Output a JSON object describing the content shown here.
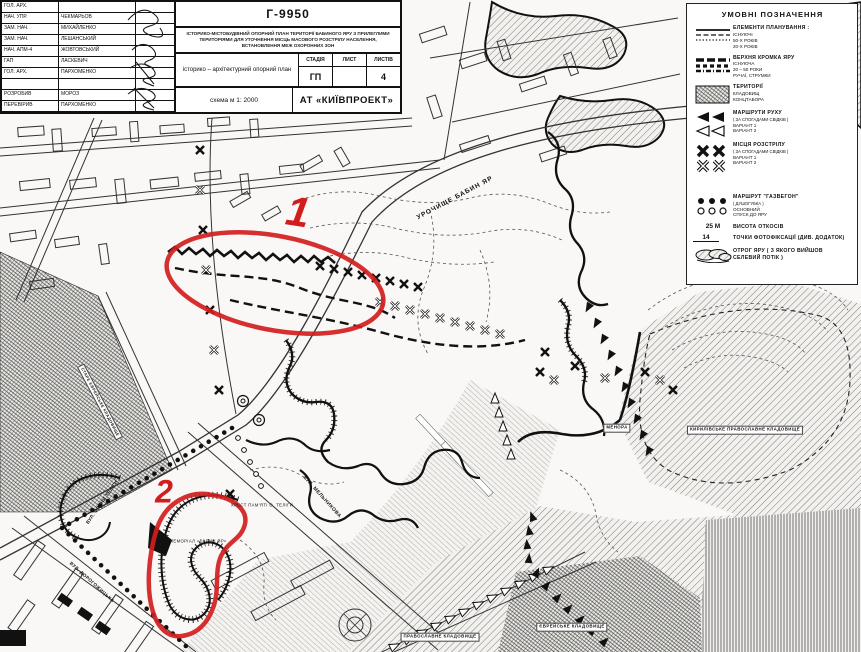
{
  "title_block": {
    "rows": [
      {
        "role": "ГОЛ. АРХ.",
        "name": ""
      },
      {
        "role": "НАЧ. УПР.",
        "name": "ЧЕКМАРЬОВ"
      },
      {
        "role": "ЗАМ. НАЧ.",
        "name": "МИХАЙЛЕНКО"
      },
      {
        "role": "ЗАМ. НАЧ.",
        "name": "ЛЕШАНСЬКИЙ"
      },
      {
        "role": "НАЧ. АПМ-4",
        "name": "ЖОВТОВСЬКИЙ"
      },
      {
        "role": "ГАП",
        "name": "ЛАСКЕВИЧ"
      },
      {
        "role": "ГОЛ. АРХ.",
        "name": "ПАРХОМЕНКО"
      },
      {
        "role": "",
        "name": ""
      },
      {
        "role": "РОЗРОБИВ",
        "name": "МОРОЗ"
      },
      {
        "role": "ПЕРЕВІРИВ",
        "name": "ПАРХОМЕНКО"
      }
    ],
    "project_code": "Г-9950",
    "description": "ІСТОРИКО-МІСТОБУДІВНИЙ ОПОРНИЙ ПЛАН ТЕРИТОРІЇ БАБИНОГО ЯРУ З ПРИЛЕГЛИМИ ТЕРИТОРІЯМИ ДЛЯ УТОЧНЕННЯ МІСЦЬ МАСОВОГО РОЗСТРІЛУ НАСЕЛЕННЯ, ВСТАНОВЛЕННЯ МЕЖ ОХОРОННИХ ЗОН",
    "doc_title": "історико – архітектурний опорний план",
    "stage_label": "СТАДІЯ",
    "sheet_label": "ЛИСТ",
    "sheets_label": "ЛИСТІВ",
    "stage_value": "ГП",
    "sheet_value": "",
    "sheets_value": "4",
    "scheme": "схема м 1: 2000",
    "company": "АТ «КИЇВПРОЕКТ»"
  },
  "legend": {
    "title": "УМОВНІ ПОЗНАЧЕННЯ",
    "planning": {
      "title": "ЕЛЕМЕНТИ ПЛАНУВАННЯ :",
      "l1": "ІСНУЮЧІ",
      "l2": "50-Х РОКІВ",
      "l3": "20-Х РОКІВ"
    },
    "edge": {
      "title": "ВЕРХНЯ КРОМКА ЯРУ",
      "l1": "ІСНУЮЧА",
      "l2": "20 – 50 РОКИ",
      "l3": "РУЧАЇ, СТРУМКИ"
    },
    "territories": {
      "title": "ТЕРИТОРІЇ",
      "l1": "КЛАДОВИЩ",
      "l2": "КОНЦТАБОРА"
    },
    "routes": {
      "title": "МАРШРУТИ РУХУ",
      "sub": "( ЗА СПОГАДАМИ СВІДКІВ )",
      "l1": "ВАРІАНТ 1",
      "l2": "ВАРІАНТ 2"
    },
    "executions": {
      "title": "МІСЦЯ РОЗСТРІЛУ",
      "sub": "( ЗА СПОГАДАМИ СВІДКІВ )",
      "l1": "ВАРІАНТ 1",
      "l2": "ВАРІАНТ 2"
    },
    "gaswagen": {
      "title": "МАРШРУТ \"ГАЗВЕГОН\"",
      "sub": "( ДУШОГУБКА )",
      "l1": "ОСНОВНИЙ",
      "l2": "СПУСК ДО ЯРУ"
    },
    "height": {
      "value": "25 М",
      "label": "ВИСОТА ОТКОСІВ"
    },
    "photo": {
      "value": "14",
      "label": "ТОЧКИ ФОТОФІКСАЦІЇ (ДИВ. ДОДАТОК)"
    },
    "spur": {
      "label": "ОТРОГ ЯРУ ( З ЯКОГО ВИЙШОВ СЕЛЕВИЙ ПОТІК )"
    }
  },
  "map": {
    "labels": {
      "tract": "УРОЧИЩЕ БАБИН ЯР",
      "melnykova": "ВУЛ. МЕЛЬНИКОВА",
      "telihy_street": "ВУЛ. ОЛЕНИ ТЕЛІГИ",
      "dorohozhytska": "ВУЛ. ДОРОГОЖИЦЬКА",
      "teliha_cross": "ХРЕСТ ПАМ'ЯТІ О. ТЕЛІГИ",
      "memorial": "МЕМОРІАЛ «БАБИН ЯР»",
      "menorah": "МЕНОРА",
      "kyrylivske": "КИРИЛІВСЬКЕ ПРАВОСЛАВНЕ КЛАДОВИЩЕ",
      "orthodox": "ПРАВОСЛАВНЕ КЛАДОВИЩЕ",
      "jewish": "ЄВРЕЙСЬКЕ КЛАДОВИЩЕ",
      "old_jewish": "СТАРЕ ЄВРЕЙСЬКЕ КЛАДОВИЩЕ"
    },
    "annotations": {
      "region1": "1",
      "region2": "2"
    }
  }
}
